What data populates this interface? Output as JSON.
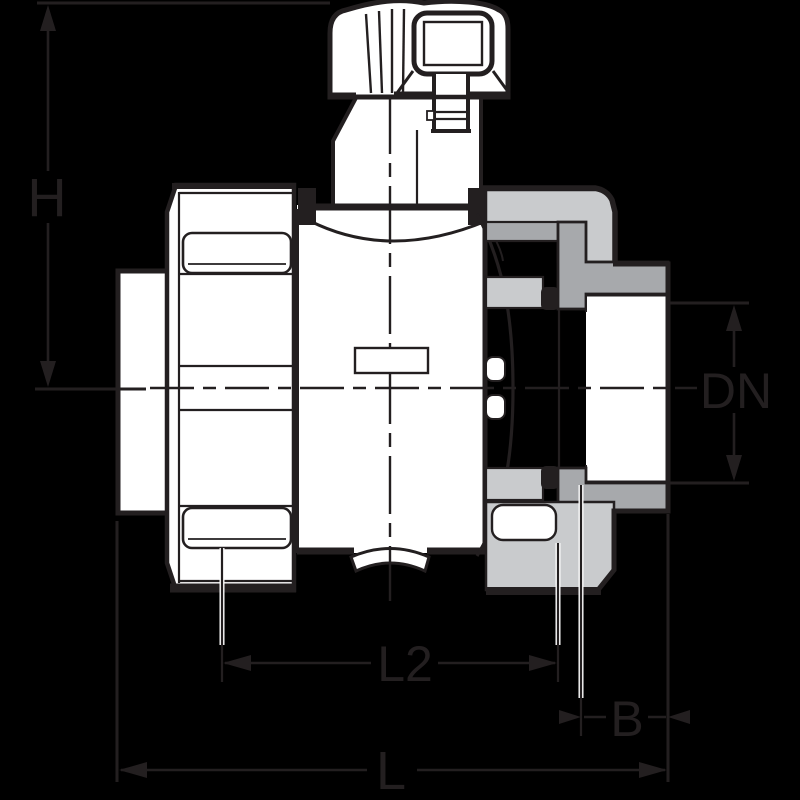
{
  "drawing": {
    "labels": {
      "height": "H",
      "nominal_diameter": "DN",
      "length_l2": "L2",
      "socket_depth": "B",
      "overall_length": "L"
    },
    "colors": {
      "background": "#000000",
      "line": "#231f20",
      "fill_white": "#ffffff",
      "light_gray": "#c9cbcd",
      "medium_gray": "#a7a9ac"
    }
  }
}
